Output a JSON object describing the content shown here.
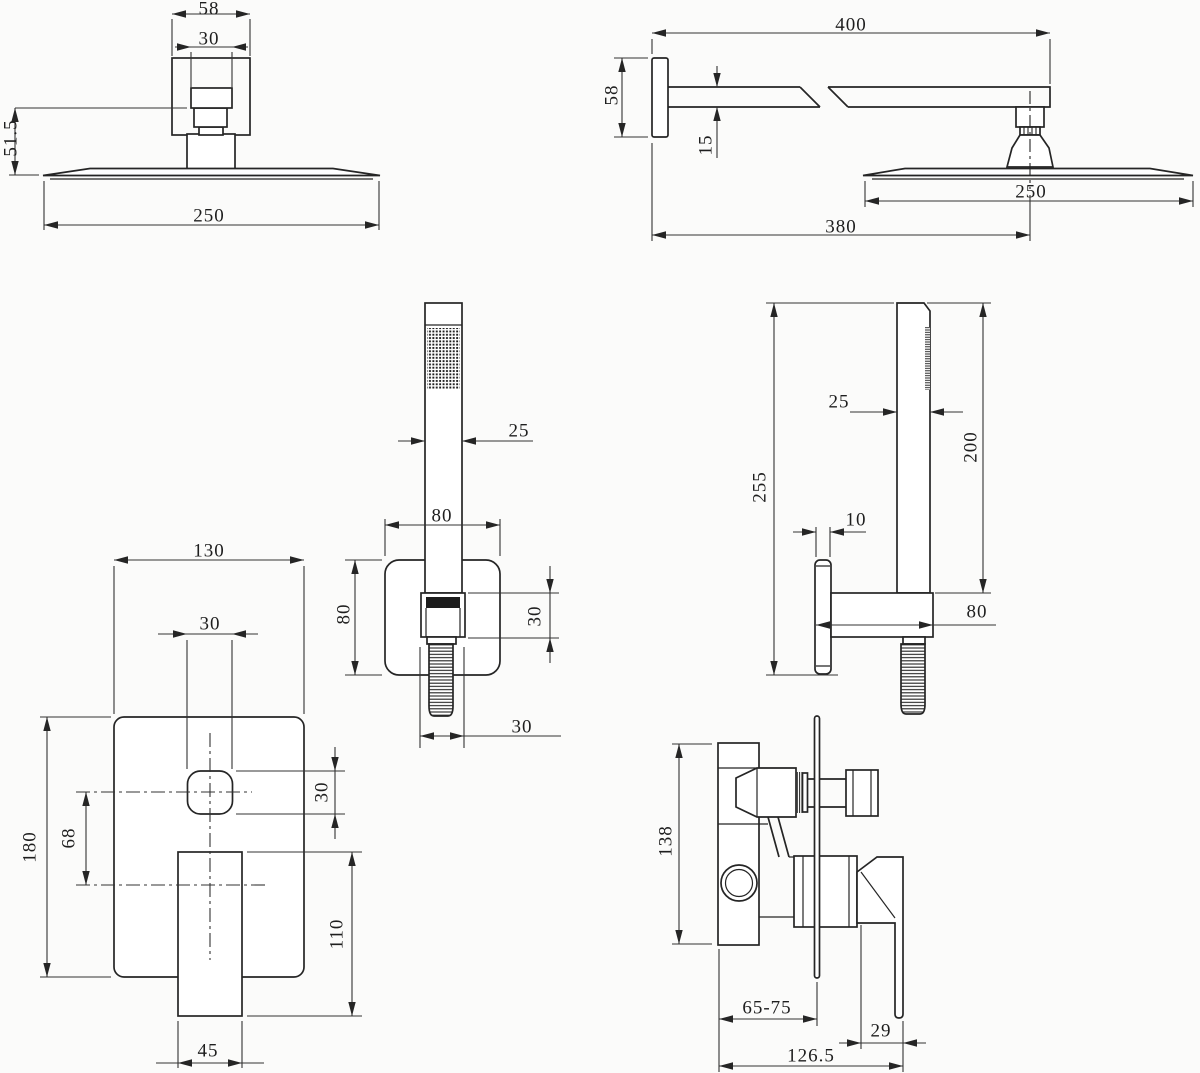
{
  "drawing": {
    "type": "engineering-dimension-drawing",
    "subject": "concealed shower set: rain head, shower arm, hand shower with wall holder, mixer valve",
    "background_color": "#fbfbfa",
    "line_color": "#252525",
    "views": {
      "shower_head_front": {
        "labels": {
          "bracket_width": "58",
          "inner_width": "30",
          "drop_height": "51.5",
          "head_diameter": "250"
        }
      },
      "shower_head_side": {
        "labels": {
          "arm_length": "400",
          "flange_height": "58",
          "arm_thickness": "15",
          "head_diameter": "250",
          "wall_to_center": "380"
        }
      },
      "hand_shower_front": {
        "labels": {
          "wand_width": "25",
          "bracket_width": "80",
          "bracket_height": "80",
          "holder_height": "30",
          "thread_width": "30"
        }
      },
      "hand_shower_side": {
        "labels": {
          "total_height": "255",
          "wand_depth": "25",
          "wand_length": "200",
          "plate_thickness": "10",
          "holder_depth": "80"
        }
      },
      "mixer_front": {
        "labels": {
          "plate_width": "130",
          "knob_width": "30",
          "plate_height": "180",
          "center_spacing": "68",
          "knob_height": "30",
          "handle_length": "110",
          "handle_width": "45"
        }
      },
      "mixer_side": {
        "labels": {
          "body_height": "138",
          "wall_depth_range": "65-75",
          "handle_offset": "29",
          "total_depth": "126.5"
        }
      }
    }
  }
}
